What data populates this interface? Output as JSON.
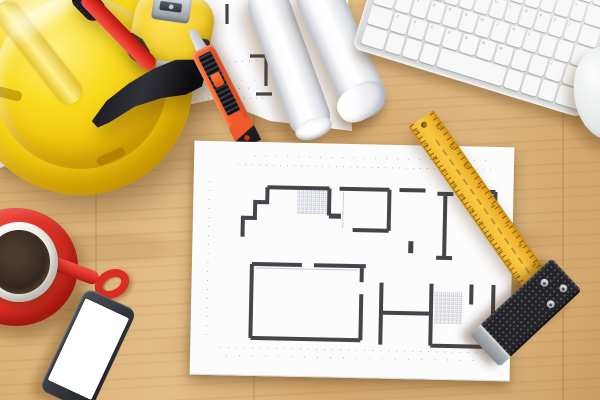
{
  "scene": {
    "name": "construction-desk-flatlay",
    "width": 600,
    "height": 400,
    "objects": [
      "hard-hat",
      "hammer",
      "tape-measure",
      "utility-knife",
      "blueprint-under-sheet",
      "blueprint-roll-1",
      "blueprint-roll-2",
      "wireless-keyboard",
      "computer-mouse",
      "floor-plan-sheet",
      "yellow-ruler-blade",
      "try-square-handle",
      "coffee-cup-with-saucer",
      "smartphone"
    ]
  },
  "palette": {
    "wood": "#d8af7c",
    "paper": "#fbfbfd",
    "plan_line": "#44444a",
    "hat_yellow": "#f3d20d",
    "hammer_red": "#e23a2a",
    "tape_yellow": "#f2ce2b",
    "knife_orange": "#ee5a2c",
    "ruler_yellow": "#f1b62c",
    "square_dark": "#26262a",
    "cup_red": "#e03227",
    "coffee_brown": "#2f2620",
    "keyboard_gray": "#e3e5e4",
    "mouse_white": "#eceeed",
    "phone_dark": "#3c4147",
    "screen_white": "#ffffff"
  },
  "keyboard": {
    "rows": [
      [
        "",
        "",
        "",
        "",
        "",
        "",
        "",
        "",
        "",
        "",
        "",
        "",
        ""
      ],
      [
        "`",
        "1",
        "2",
        "3",
        "4",
        "5",
        "6",
        "7",
        "8",
        "9",
        "0",
        "-",
        "=",
        ""
      ],
      [
        "",
        "Q",
        "W",
        "E",
        "R",
        "T",
        "Y",
        "U",
        "I",
        "O",
        "P",
        "[",
        "]",
        ""
      ],
      [
        "",
        "A",
        "S",
        "D",
        "F",
        "G",
        "H",
        "J",
        "K",
        "L",
        ";",
        "'",
        ""
      ],
      [
        "",
        "Z",
        "X",
        "C",
        "V",
        "B",
        "N",
        "M",
        ",",
        ".",
        "/",
        ""
      ],
      [
        "",
        "",
        "",
        "",
        "SPACE",
        "",
        "",
        "",
        ""
      ]
    ]
  },
  "ruler": {
    "cm_numbers": [
      "30",
      "29",
      "28",
      "27",
      "26",
      "25",
      "24",
      "23",
      "22",
      "21",
      "20",
      "19"
    ],
    "inch_numbers": [
      "12",
      "11",
      "10",
      "9",
      "8",
      "7",
      "6",
      "5",
      "4"
    ]
  }
}
